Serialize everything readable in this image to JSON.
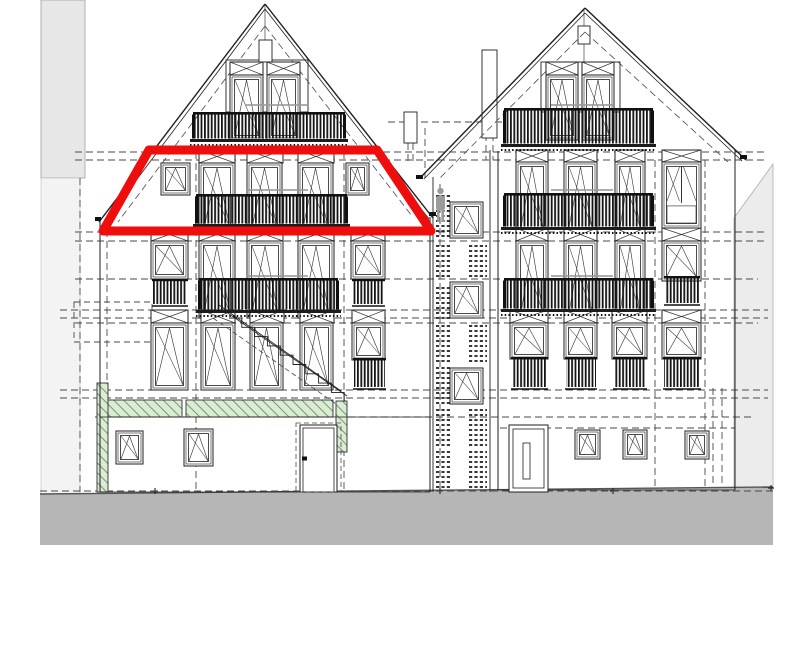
{
  "title": "building-elevation-drawing",
  "canvas": {
    "w": 809,
    "h": 652,
    "bg": "#ffffff"
  },
  "colors": {
    "line": "#1f1f1f",
    "thin": "#3a3a3a",
    "dash": "#4a4a4a",
    "red_highlight": "#ee0e0e",
    "green_fill": "#dcebd4",
    "green_hatch": "#6f9b6f",
    "ground_fill": "#b6b6b6",
    "neighbor_left_top": "#e7e7e7",
    "neighbor_left_bottom": "#f3f3f3",
    "neighbor_right": "#ececec",
    "bars": "#141414",
    "annotation": "#9a9a9a",
    "person": "#9b9b9b"
  },
  "neighbors": {
    "left_top": [
      41,
      0,
      44,
      178
    ],
    "left_bottom": [
      41,
      178,
      39,
      316
    ],
    "right_polygon": [
      [
        734,
        218
      ],
      [
        773,
        164
      ],
      [
        773,
        489
      ],
      [
        734,
        489
      ]
    ]
  },
  "ground": {
    "polygon": [
      [
        40,
        494
      ],
      [
        773,
        487
      ],
      [
        773,
        545
      ],
      [
        40,
        545
      ]
    ],
    "top_edge": [
      40,
      494,
      773,
      487
    ],
    "cross_marks": [
      [
        155,
        491
      ],
      [
        440,
        491
      ],
      [
        613,
        491
      ],
      [
        771,
        488
      ]
    ]
  },
  "red_highlight": {
    "points": [
      [
        103,
        231
      ],
      [
        149,
        150
      ],
      [
        377,
        150
      ],
      [
        431,
        231
      ]
    ],
    "width": 9
  },
  "roof_segments": {
    "solid": [
      [
        99,
        222,
        265,
        4,
        1.4
      ],
      [
        104,
        223,
        265,
        9,
        0.8
      ],
      [
        265,
        4,
        433,
        218,
        1.4
      ],
      [
        265,
        9,
        429,
        219,
        0.8
      ],
      [
        420,
        178,
        585,
        8,
        1.4
      ],
      [
        424,
        179,
        585,
        13,
        0.8
      ],
      [
        585,
        8,
        746,
        160,
        1.4
      ],
      [
        585,
        13,
        742,
        161,
        0.8
      ]
    ],
    "dashed": [
      [
        265,
        26,
        118,
        222
      ],
      [
        265,
        26,
        412,
        216
      ],
      [
        585,
        32,
        440,
        178
      ],
      [
        585,
        32,
        728,
        162
      ]
    ]
  },
  "solid_lines": [
    [
      100,
      221,
      100,
      492,
      1
    ],
    [
      430,
      217,
      430,
      492,
      1
    ],
    [
      100,
      492,
      430,
      492,
      0.8
    ],
    [
      433,
      177,
      433,
      492,
      0.9
    ],
    [
      490,
      150,
      490,
      492,
      0.9
    ],
    [
      498,
      151,
      498,
      490,
      1
    ],
    [
      735,
      150,
      735,
      490,
      1
    ],
    [
      498,
      490,
      735,
      490,
      0.8
    ],
    [
      100,
      417,
      430,
      417,
      0.8
    ],
    [
      265,
      4,
      265,
      104,
      0.6
    ],
    [
      584,
      10,
      584,
      72,
      0.6
    ],
    [
      482,
      57,
      497,
      57,
      0.7
    ],
    [
      482,
      61,
      497,
      61,
      0.7
    ],
    [
      404,
      118,
      417,
      118,
      0.6
    ],
    [
      404,
      124,
      417,
      124,
      0.6
    ]
  ],
  "outline_rects": [
    [
      226,
      60,
      82,
      52
    ],
    [
      541,
      62,
      79,
      50
    ],
    [
      259,
      40,
      13,
      22
    ],
    [
      578,
      26,
      12,
      18
    ],
    [
      482,
      50,
      15,
      88
    ],
    [
      404,
      112,
      13,
      31
    ]
  ],
  "eave_ticks": [
    [
      95,
      217,
      6,
      4
    ],
    [
      429,
      212,
      7,
      4
    ],
    [
      416,
      175,
      7,
      4
    ],
    [
      740,
      155,
      7,
      4
    ]
  ],
  "dashed_h": [
    [
      388,
      502,
      122
    ],
    [
      75,
      768,
      152
    ],
    [
      75,
      768,
      160
    ],
    [
      75,
      768,
      232
    ],
    [
      75,
      768,
      241
    ],
    [
      75,
      758,
      279
    ],
    [
      60,
      768,
      310
    ],
    [
      60,
      768,
      318
    ],
    [
      75,
      758,
      323
    ],
    [
      60,
      768,
      390
    ],
    [
      60,
      768,
      398
    ],
    [
      95,
      755,
      417
    ],
    [
      500,
      735,
      428
    ],
    [
      40,
      775,
      491
    ]
  ],
  "dashed_v": [
    [
      80,
      178,
      492
    ],
    [
      107,
      230,
      490
    ],
    [
      196,
      152,
      490
    ],
    [
      344,
      152,
      490
    ],
    [
      425,
      128,
      178
    ],
    [
      440,
      184,
      490
    ],
    [
      486,
      112,
      160
    ],
    [
      493,
      112,
      160
    ],
    [
      408,
      143,
      162
    ],
    [
      413,
      143,
      162
    ],
    [
      655,
      160,
      487
    ],
    [
      705,
      160,
      487
    ],
    [
      713,
      388,
      487
    ],
    [
      722,
      388,
      487
    ]
  ],
  "dashed_box": [
    74,
    302,
    78,
    40
  ],
  "green": {
    "bands": [
      [
        100,
        400,
        82,
        17
      ],
      [
        186,
        400,
        147,
        17
      ]
    ],
    "posts": [
      [
        336,
        401,
        11,
        51
      ],
      [
        97,
        383,
        11,
        109
      ]
    ]
  },
  "windows": [
    [
      230,
      62,
      33,
      13,
      "t"
    ],
    [
      267,
      62,
      33,
      13,
      "t"
    ],
    [
      230,
      75,
      33,
      65,
      "d"
    ],
    [
      267,
      75,
      33,
      65,
      "d"
    ],
    [
      199,
      150,
      36,
      13,
      "t"
    ],
    [
      247,
      150,
      36,
      13,
      "t"
    ],
    [
      298,
      150,
      36,
      13,
      "t"
    ],
    [
      161,
      163,
      29,
      32,
      "s"
    ],
    [
      346,
      163,
      23,
      32,
      "s"
    ],
    [
      199,
      163,
      36,
      70,
      "d"
    ],
    [
      247,
      163,
      35,
      70,
      "d"
    ],
    [
      298,
      163,
      35,
      70,
      "d"
    ],
    [
      151,
      228,
      37,
      13,
      "t"
    ],
    [
      199,
      228,
      36,
      13,
      "t"
    ],
    [
      247,
      228,
      36,
      13,
      "t"
    ],
    [
      298,
      228,
      36,
      13,
      "t"
    ],
    [
      351,
      228,
      34,
      13,
      "t"
    ],
    [
      151,
      241,
      37,
      38,
      "w"
    ],
    [
      351,
      241,
      34,
      38,
      "w"
    ],
    [
      199,
      241,
      36,
      77,
      "d"
    ],
    [
      247,
      241,
      36,
      77,
      "d"
    ],
    [
      298,
      241,
      36,
      77,
      "d"
    ],
    [
      151,
      310,
      37,
      13,
      "t"
    ],
    [
      201,
      310,
      34,
      13,
      "t"
    ],
    [
      250,
      310,
      34,
      13,
      "t"
    ],
    [
      300,
      310,
      34,
      13,
      "t"
    ],
    [
      352,
      310,
      33,
      13,
      "t"
    ],
    [
      151,
      323,
      37,
      67,
      "w"
    ],
    [
      352,
      323,
      33,
      37,
      "w"
    ],
    [
      201,
      323,
      34,
      67,
      "d"
    ],
    [
      250,
      323,
      33,
      67,
      "d"
    ],
    [
      300,
      323,
      33,
      67,
      "d"
    ],
    [
      116,
      431,
      27,
      33,
      "s"
    ],
    [
      184,
      429,
      29,
      37,
      "s"
    ],
    [
      300,
      425,
      37,
      67,
      "doorL"
    ],
    [
      546,
      62,
      32,
      13,
      "t"
    ],
    [
      582,
      62,
      32,
      13,
      "t"
    ],
    [
      546,
      75,
      32,
      65,
      "d"
    ],
    [
      582,
      75,
      32,
      65,
      "d"
    ],
    [
      516,
      150,
      32,
      12,
      "t"
    ],
    [
      564,
      150,
      33,
      12,
      "t"
    ],
    [
      615,
      150,
      30,
      12,
      "t"
    ],
    [
      662,
      150,
      39,
      12,
      "t"
    ],
    [
      516,
      162,
      32,
      70,
      "d"
    ],
    [
      564,
      162,
      33,
      70,
      "d"
    ],
    [
      615,
      162,
      30,
      70,
      "d"
    ],
    [
      662,
      162,
      39,
      66,
      "w2"
    ],
    [
      516,
      228,
      32,
      13,
      "t"
    ],
    [
      564,
      228,
      33,
      13,
      "t"
    ],
    [
      615,
      228,
      30,
      13,
      "t"
    ],
    [
      662,
      228,
      39,
      13,
      "t"
    ],
    [
      516,
      241,
      32,
      77,
      "d"
    ],
    [
      564,
      241,
      33,
      77,
      "d"
    ],
    [
      615,
      241,
      30,
      77,
      "d"
    ],
    [
      662,
      241,
      39,
      40,
      "w"
    ],
    [
      510,
      310,
      38,
      13,
      "t"
    ],
    [
      564,
      310,
      33,
      13,
      "t"
    ],
    [
      612,
      310,
      35,
      13,
      "t"
    ],
    [
      662,
      310,
      39,
      13,
      "t"
    ],
    [
      510,
      323,
      38,
      36,
      "w"
    ],
    [
      564,
      323,
      33,
      36,
      "w"
    ],
    [
      612,
      323,
      35,
      36,
      "w"
    ],
    [
      662,
      323,
      39,
      36,
      "w"
    ],
    [
      509,
      425,
      39,
      67,
      "doorR"
    ],
    [
      575,
      430,
      25,
      29,
      "s"
    ],
    [
      623,
      430,
      24,
      29,
      "s"
    ],
    [
      685,
      431,
      24,
      28,
      "s"
    ],
    [
      450,
      202,
      33,
      36,
      "s"
    ],
    [
      450,
      282,
      33,
      36,
      "s"
    ],
    [
      450,
      368,
      33,
      36,
      "s"
    ]
  ],
  "railings": [
    [
      194,
      112,
      150,
      35
    ],
    [
      197,
      194,
      149,
      38
    ],
    [
      200,
      278,
      137,
      40
    ],
    [
      505,
      108,
      147,
      44
    ],
    [
      505,
      193,
      147,
      42
    ],
    [
      505,
      278,
      147,
      39
    ]
  ],
  "juliets": [
    [
      153,
      279,
      34,
      28
    ],
    [
      353,
      279,
      31,
      28
    ],
    [
      354,
      358,
      31,
      32
    ],
    [
      665,
      276,
      34,
      30
    ],
    [
      512,
      357,
      35,
      33
    ],
    [
      566,
      357,
      30,
      33
    ],
    [
      614,
      357,
      32,
      33
    ],
    [
      664,
      357,
      36,
      33
    ]
  ],
  "stairs": {
    "steps_start": [
      229,
      318
    ],
    "step_dx": 12.8,
    "step_dy": 9.3,
    "step_count": 9,
    "stringer": [
      225,
      311,
      347,
      396
    ],
    "rail": [
      219,
      305,
      341,
      391
    ],
    "dashed_stringer": [
      213,
      318,
      336,
      404
    ]
  },
  "tread_stacks": [
    {
      "x": 436,
      "w": 15,
      "y1": 196,
      "y2": 238
    },
    {
      "x": 436,
      "w": 15,
      "y1": 246,
      "y2": 280
    },
    {
      "x": 436,
      "w": 15,
      "y1": 288,
      "y2": 318
    },
    {
      "x": 436,
      "w": 15,
      "y1": 326,
      "y2": 362
    },
    {
      "x": 436,
      "w": 15,
      "y1": 368,
      "y2": 403
    },
    {
      "x": 436,
      "w": 15,
      "y1": 410,
      "y2": 446
    },
    {
      "x": 436,
      "w": 15,
      "y1": 452,
      "y2": 488
    },
    {
      "x": 469,
      "w": 18,
      "y1": 246,
      "y2": 280
    },
    {
      "x": 469,
      "w": 18,
      "y1": 326,
      "y2": 362
    },
    {
      "x": 469,
      "w": 18,
      "y1": 410,
      "y2": 446
    },
    {
      "x": 469,
      "w": 18,
      "y1": 452,
      "y2": 488
    }
  ],
  "person": {
    "head": [
      440.5,
      191,
      3.2
    ],
    "body": [
      436,
      196,
      9,
      14
    ],
    "legs_bottom": 222
  },
  "annotations": [
    [
      246,
      104,
      62
    ],
    [
      551,
      104,
      62
    ],
    [
      246,
      189,
      62
    ],
    [
      551,
      189,
      62
    ],
    [
      246,
      275,
      62
    ],
    [
      551,
      275,
      62
    ]
  ]
}
